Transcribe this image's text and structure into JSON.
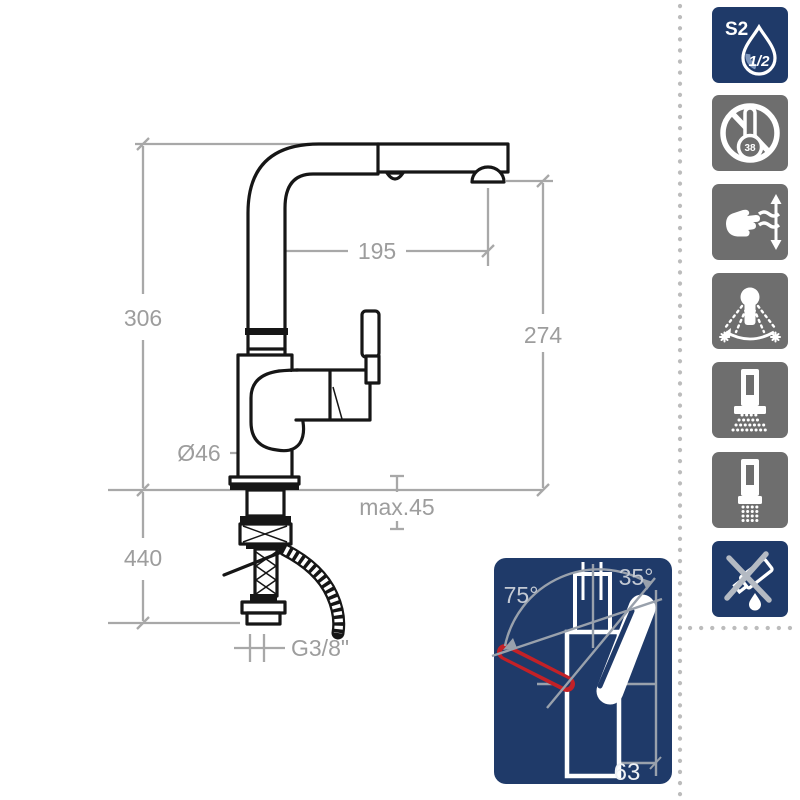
{
  "colors": {
    "navy": "#1f3a69",
    "gray": "#6e6e6e",
    "red": "#c32127",
    "ink": "#161616",
    "dim_line": "#a8a8a8",
    "dim_text": "#9d9d9d",
    "inset_line": "#99a1ac",
    "inset_text": "#c3c9d3",
    "inset_bright": "#eef1f5",
    "cross_gray": "#b4bac3",
    "dot_gray": "#bcbcbc",
    "drop_shade": "#7e97bd"
  },
  "drawing": {
    "dims": {
      "height_to_spout_top": "306",
      "spout_reach": "195",
      "spout_outlet_height": "274",
      "body_diameter": "Ø46",
      "max_deck_thickness": "max.45",
      "below_deck_length": "440",
      "supply_thread": "G3/8\""
    }
  },
  "inset": {
    "left_angle": "75°",
    "right_angle": "35°",
    "handle_length": "63"
  },
  "icons": [
    {
      "id": "flow-class-s2-half",
      "label": "S2",
      "drop_text": "1/2"
    },
    {
      "id": "thermostatic-38-crossed",
      "bulb_text": "38"
    },
    {
      "id": "pull-out-hand-spray"
    },
    {
      "id": "swivel-spray-modes"
    },
    {
      "id": "shower-jet"
    },
    {
      "id": "laminar-jet"
    },
    {
      "id": "no-harsh-cleaners"
    }
  ]
}
